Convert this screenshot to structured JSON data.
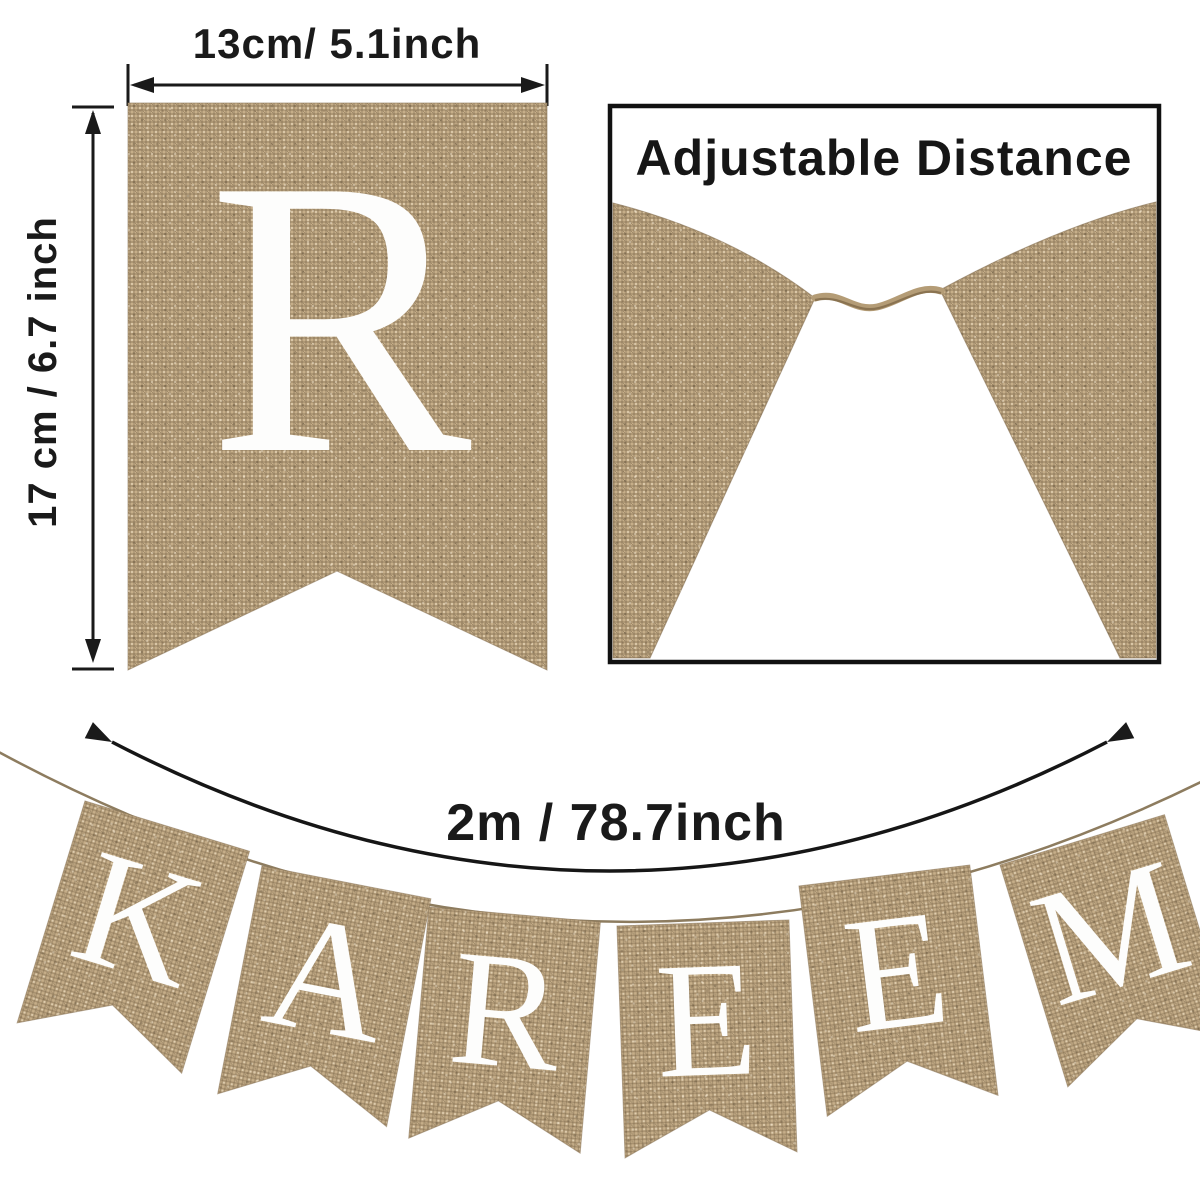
{
  "figure": {
    "background": "#ffffff",
    "single_pennant": {
      "letter": "R",
      "width_label": "13cm/ 5.1inch",
      "height_label": "17 cm / 6.7 inch"
    },
    "adjustable_panel": {
      "title": "Adjustable Distance"
    },
    "banner": {
      "length_label": "2m / 78.7inch",
      "word": "KAREEM",
      "pennants": [
        {
          "letter": "K"
        },
        {
          "letter": "A"
        },
        {
          "letter": "R"
        },
        {
          "letter": "E"
        },
        {
          "letter": "E"
        },
        {
          "letter": "M"
        }
      ]
    },
    "colors": {
      "burlap": "#c6ae89",
      "letter": "#fdfdfc",
      "annotation": "#1a1a1a",
      "twine": "#b49c76",
      "panel_border": "#111111"
    }
  }
}
